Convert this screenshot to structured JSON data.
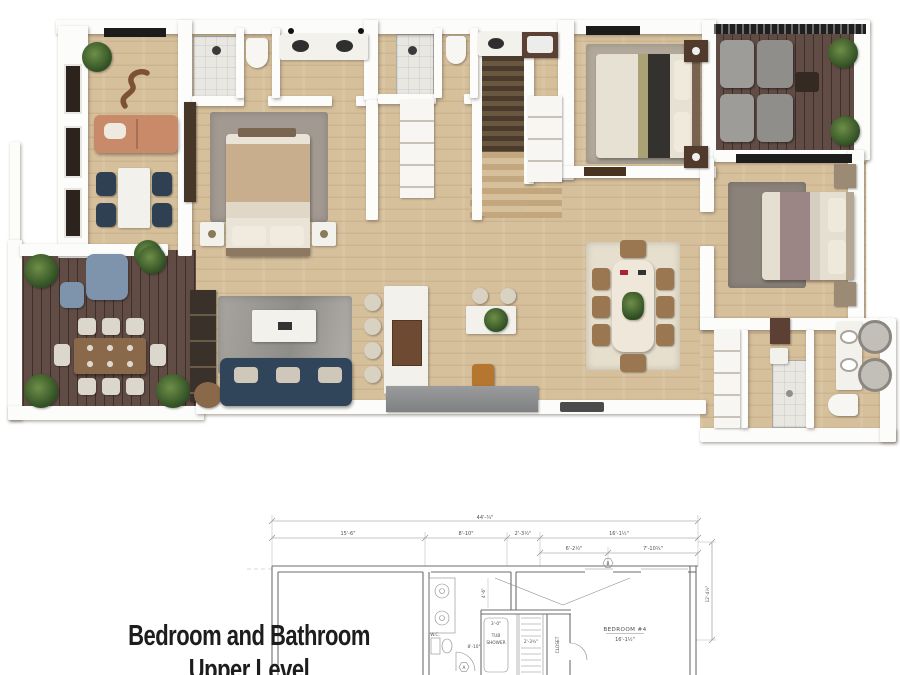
{
  "caption": {
    "line1": "Bedroom and Bathroom",
    "line2": "Upper Level"
  },
  "blueprint": {
    "dims": {
      "overall": "44'-¾\"",
      "seg_15_6": "15'-6\"",
      "seg_8_10": "8'-10\"",
      "seg_2_3": "2'-3½\"",
      "seg_16_1": "16'-1½\"",
      "seg_6_2": "6'-2½\"",
      "seg_7_10": "7'-10¾\"",
      "side_12_4": "12'-4½\"",
      "bath_8_10": "8'-10\"",
      "tub_3_0": "3'-0\"",
      "hall_4_6": "4'-6\"",
      "stair_2_3": "2'-3¾\"",
      "wc": "W.C."
    },
    "labels": {
      "tub1": "TUB",
      "tub2": "SHOWER",
      "closet": "CLOSET",
      "bedroom4": "BEDROOM #4",
      "bedroom4_dim": "16'-1½\"",
      "marker_a": "A",
      "marker_b": "B"
    }
  },
  "palette": {
    "floor_light": "#d6c09c",
    "floor_dark": "#59433b",
    "wall_white": "#fcfcfb",
    "rug_gray": "#a0a19e",
    "rug_cream": "#e7dfcd",
    "sofa_navy": "#30445a",
    "sofa_coral": "#c98a6a",
    "cabinet_brown": "#6e4a32",
    "plant_green": "#3f6130",
    "blueprint_line": "#8a8a8a",
    "caption_text": "#1d1d1d"
  }
}
